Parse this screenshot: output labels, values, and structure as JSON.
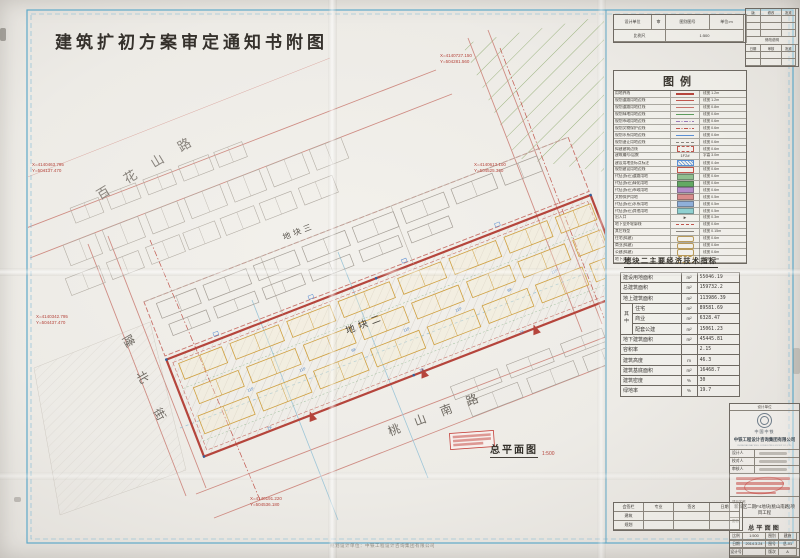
{
  "page": {
    "title": "建筑扩初方案审定通知书附图",
    "plan_caption": "总平面图",
    "plan_scale": "1:500",
    "footnote": "规划设计单位：中铁工程设计咨询集团有限公司"
  },
  "header_table": {
    "row1": [
      "设计单位",
      "审",
      "图别图号",
      "单位:m"
    ],
    "row2": [
      "比例尺",
      "1:500"
    ]
  },
  "revision": {
    "rows": [
      [
        "版",
        "修改",
        "批准"
      ],
      [
        "",
        "",
        ""
      ],
      [
        "",
        "",
        ""
      ],
      [
        "",
        "",
        ""
      ],
      [
        "修改说明"
      ],
      [
        "日期",
        "审核",
        "批准"
      ],
      [
        "",
        "",
        ""
      ],
      [
        "",
        "",
        ""
      ]
    ]
  },
  "legend": {
    "title": "图例",
    "rows": [
      {
        "name": "用地界线",
        "spec": "线宽 1.2m",
        "sw": {
          "t": "line",
          "c": "#b5453c",
          "w": 2
        }
      },
      {
        "name": "规划道路用地边线",
        "spec": "线宽 1.2m",
        "sw": {
          "t": "line",
          "c": "#c0564d",
          "w": 1.5
        }
      },
      {
        "name": "规划道路用地红线",
        "spec": "线宽 0.8m",
        "sw": {
          "t": "line",
          "c": "#c8736b",
          "w": 1
        }
      },
      {
        "name": "规划绿地用地边线",
        "spec": "线宽 0.6m",
        "sw": {
          "t": "line",
          "c": "#5d9c5d",
          "w": 1
        }
      },
      {
        "name": "规划市政用地边线",
        "spec": "线宽 0.6m",
        "sw": {
          "t": "dashdot",
          "c": "#9a7ab8"
        }
      },
      {
        "name": "规划文物保护边线",
        "spec": "线宽 0.6m",
        "sw": {
          "t": "dashdot",
          "c": "#c0564d"
        }
      },
      {
        "name": "规划水系用地边线",
        "spec": "线宽 0.6m",
        "sw": {
          "t": "line",
          "c": "#5b8fd4",
          "w": 1
        }
      },
      {
        "name": "规划退让用地边线",
        "spec": "线宽 0.6m",
        "sw": {
          "t": "dash",
          "c": "#8a857e"
        }
      },
      {
        "name": "拟建建筑边线",
        "spec": "线宽 0.6m",
        "sw": {
          "t": "rect",
          "c": "#c0564d",
          "dash": true
        }
      },
      {
        "name": "建筑编号/层数",
        "spec": "字高 3.0m",
        "sw": {
          "t": "text",
          "c": "#4a463f",
          "txt": "1F2#"
        }
      },
      {
        "name": "建设用地坐标点标注",
        "spec": "线宽 0.4m",
        "sw": {
          "t": "hatch",
          "c": "#5b8fd4"
        }
      },
      {
        "name": "规划建设用地边线",
        "spec": "线宽 0.6m",
        "sw": {
          "t": "rect",
          "c": "#c0564d"
        }
      },
      {
        "name": "代征(拆迁)道路用地",
        "spec": "线宽 0.6m",
        "sw": {
          "t": "fill",
          "c": "#8fbf8f"
        }
      },
      {
        "name": "代征(拆迁)绿化用地",
        "spec": "线宽 0.6m",
        "sw": {
          "t": "fill",
          "c": "#63a963"
        }
      },
      {
        "name": "代征(拆迁)市政用地",
        "spec": "线宽 0.6m",
        "sw": {
          "t": "fill",
          "c": "#b48cc8"
        }
      },
      {
        "name": "文物保护用地",
        "spec": "线宽 0.5m",
        "sw": {
          "t": "fill",
          "c": "#d98c8c"
        }
      },
      {
        "name": "代征(拆迁)水系用地",
        "spec": "线宽 0.5m",
        "sw": {
          "t": "fill",
          "c": "#8fb0d9"
        }
      },
      {
        "name": "代征(拆迁)其他用地",
        "spec": "线宽 0.5m",
        "sw": {
          "t": "fill",
          "c": "#8fd0d0"
        }
      },
      {
        "name": "出入口",
        "spec": "线宽 0.3m",
        "sw": {
          "t": "arrow",
          "c": "#55504a"
        }
      },
      {
        "name": "地下室外轮廓线",
        "spec": "线宽 0.6m",
        "sw": {
          "t": "dash",
          "c": "#c0564d"
        }
      },
      {
        "name": "其它线型",
        "spec": "线宽 0.15m",
        "sw": {
          "t": "line",
          "c": "#8a857e",
          "w": 0.5
        }
      },
      {
        "name": "住宅(拟建)",
        "spec": "线宽 0.6m",
        "sw": {
          "t": "round",
          "c": "#b89a5a"
        }
      },
      {
        "name": "商业(拟建)",
        "spec": "线宽 0.6m",
        "sw": {
          "t": "round",
          "c": "#b89a5a"
        }
      },
      {
        "name": "公建(拟建)",
        "spec": "线宽 0.6m",
        "sw": {
          "t": "round",
          "c": "#b89a5a"
        }
      },
      {
        "name": "地下(拟建)",
        "spec": "线宽 0.5m",
        "sw": {
          "t": "round",
          "c": "#b89a5a",
          "dash": true
        }
      }
    ]
  },
  "indicators": {
    "title": "地块二主要经济技术指标",
    "rows": [
      {
        "label": "建设用地面积",
        "unit": "m²",
        "value": "55046.19"
      },
      {
        "label": "总建筑面积",
        "unit": "m²",
        "value": "159732.2"
      },
      {
        "label": "地上建筑面积",
        "unit": "m²",
        "value": "113986.39"
      },
      {
        "label": "住宅",
        "unit": "m²",
        "value": "89581.69",
        "sub": true,
        "group": "其\n中"
      },
      {
        "label": "商业",
        "unit": "m²",
        "value": "6328.47",
        "sub": true
      },
      {
        "label": "配套公建",
        "unit": "m²",
        "value": "15061.23",
        "sub": true
      },
      {
        "label": "地下建筑面积",
        "unit": "m²",
        "value": "45445.81"
      },
      {
        "label": "容积率",
        "unit": "",
        "value": "2.15"
      },
      {
        "label": "建筑高度",
        "unit": "m",
        "value": "46.3"
      },
      {
        "label": "建筑基底面积",
        "unit": "m²",
        "value": "16468.7"
      },
      {
        "label": "建筑密度",
        "unit": "%",
        "value": "30"
      },
      {
        "label": "绿地率",
        "unit": "%",
        "value": "19.7"
      }
    ]
  },
  "titleblock": {
    "unit_label": "设计单位",
    "brand": "中国中铁",
    "company": "中铁工程设计咨询集团有限公司",
    "company_en": "CHINA RAILWAY ENG. CONSULTING GROUP CO.,LTD.",
    "sig_rows": [
      "设计人",
      "校对人",
      "审核人"
    ],
    "project_label": "项目名称",
    "project": "新城区二期F4地块(桃山南路)项目工程",
    "name_label": "图名",
    "drawing_name": "总平面图",
    "meta": [
      [
        "比例",
        "1:500",
        "图别",
        "建施"
      ],
      [
        "日期",
        "2014.3.24",
        "图号",
        "总-01"
      ],
      [
        "设计号",
        "",
        "版次",
        "A"
      ]
    ]
  },
  "signoff": {
    "rows": [
      [
        "会签栏",
        "专业",
        "签名",
        "日期"
      ],
      [
        "建筑",
        "",
        "",
        ""
      ],
      [
        "规划",
        "",
        "",
        ""
      ]
    ]
  },
  "map": {
    "street_names": [
      "百花山路",
      "隆北街",
      "桃山南路"
    ],
    "zone_names": [
      "地块三",
      "地块二"
    ],
    "labels": [
      {
        "t": "百",
        "x": 100,
        "y": 200,
        "s": 13,
        "c": "#87827b",
        "r": -31
      },
      {
        "t": "花",
        "x": 127,
        "y": 184,
        "s": 13,
        "c": "#87827b",
        "r": -31
      },
      {
        "t": "山",
        "x": 154,
        "y": 168,
        "s": 13,
        "c": "#87827b",
        "r": -31
      },
      {
        "t": "路",
        "x": 181,
        "y": 152,
        "s": 13,
        "c": "#87827b",
        "r": -31
      },
      {
        "t": "隆",
        "x": 122,
        "y": 338,
        "s": 12,
        "c": "#6f6a63",
        "r": 60
      },
      {
        "t": "北",
        "x": 136,
        "y": 374,
        "s": 12,
        "c": "#6f6a63",
        "r": 60
      },
      {
        "t": "街",
        "x": 153,
        "y": 411,
        "s": 12,
        "c": "#6f6a63",
        "r": 60
      },
      {
        "t": "桃",
        "x": 390,
        "y": 436,
        "s": 12,
        "c": "#6f6a63",
        "r": -21
      },
      {
        "t": "山",
        "x": 416,
        "y": 426,
        "s": 12,
        "c": "#6f6a63",
        "r": -21
      },
      {
        "t": "南",
        "x": 442,
        "y": 416,
        "s": 12,
        "c": "#6f6a63",
        "r": -21
      },
      {
        "t": "路",
        "x": 468,
        "y": 406,
        "s": 12,
        "c": "#6f6a63",
        "r": -21
      },
      {
        "t": "地块三",
        "x": 284,
        "y": 240,
        "s": 8,
        "c": "#5a554e",
        "r": -21,
        "ls": 3
      },
      {
        "t": "地块二",
        "x": 347,
        "y": 334,
        "s": 9.5,
        "c": "#45413a",
        "r": -21,
        "ls": 4
      },
      {
        "t": "X=4140727.150",
        "x": 440,
        "y": 57,
        "s": 4.5,
        "c": "#b5453c"
      },
      {
        "t": "Y=504281.560",
        "x": 440,
        "y": 63,
        "s": 4.5,
        "c": "#b5453c"
      },
      {
        "t": "X=4140613.100",
        "x": 474,
        "y": 166,
        "s": 4.5,
        "c": "#b5453c"
      },
      {
        "t": "Y=504525.360",
        "x": 474,
        "y": 172,
        "s": 4.5,
        "c": "#b5453c"
      },
      {
        "t": "X=4140463.795",
        "x": 32,
        "y": 166,
        "s": 4.5,
        "c": "#b5453c"
      },
      {
        "t": "Y=504137.470",
        "x": 32,
        "y": 172,
        "s": 4.5,
        "c": "#b5453c"
      },
      {
        "t": "X=4140342.795",
        "x": 36,
        "y": 318,
        "s": 4.5,
        "c": "#b5453c"
      },
      {
        "t": "Y=504437.470",
        "x": 36,
        "y": 324,
        "s": 4.5,
        "c": "#b5453c"
      },
      {
        "t": "X=4140191.220",
        "x": 250,
        "y": 500,
        "s": 4.5,
        "c": "#b5453c"
      },
      {
        "t": "Y=504536.180",
        "x": 250,
        "y": 506,
        "s": 4.5,
        "c": "#b5453c"
      },
      {
        "t": "11F",
        "x": 248,
        "y": 392,
        "s": 4,
        "c": "#4a7fc1",
        "r": -21
      },
      {
        "t": "11F",
        "x": 300,
        "y": 372,
        "s": 4,
        "c": "#4a7fc1",
        "r": -21
      },
      {
        "t": "6F",
        "x": 352,
        "y": 352,
        "s": 4,
        "c": "#4a7fc1",
        "r": -21
      },
      {
        "t": "11F",
        "x": 404,
        "y": 332,
        "s": 4,
        "c": "#4a7fc1",
        "r": -21
      },
      {
        "t": "11F",
        "x": 456,
        "y": 312,
        "s": 4,
        "c": "#4a7fc1",
        "r": -21
      },
      {
        "t": "6F",
        "x": 508,
        "y": 292,
        "s": 4,
        "c": "#4a7fc1",
        "r": -21
      },
      {
        "t": "11F",
        "x": 552,
        "y": 274,
        "s": 4,
        "c": "#4a7fc1",
        "r": -21
      },
      {
        "t": "2F",
        "x": 268,
        "y": 430,
        "s": 4,
        "c": "#4a7fc1",
        "r": -21
      },
      {
        "t": "2F",
        "x": 420,
        "y": 372,
        "s": 4,
        "c": "#4a7fc1",
        "r": -21
      },
      {
        "t": "1F",
        "x": 520,
        "y": 334,
        "s": 4,
        "c": "#4a7fc1",
        "r": -21
      }
    ]
  },
  "colors": {
    "boundary_red": "#b5453c",
    "building_orange": "#cfa040",
    "annotation_blue": "#4a7fc1",
    "green_hatch": "#93ae74",
    "frame_blue": "#5fa9c9",
    "paper": "#edebe6"
  }
}
